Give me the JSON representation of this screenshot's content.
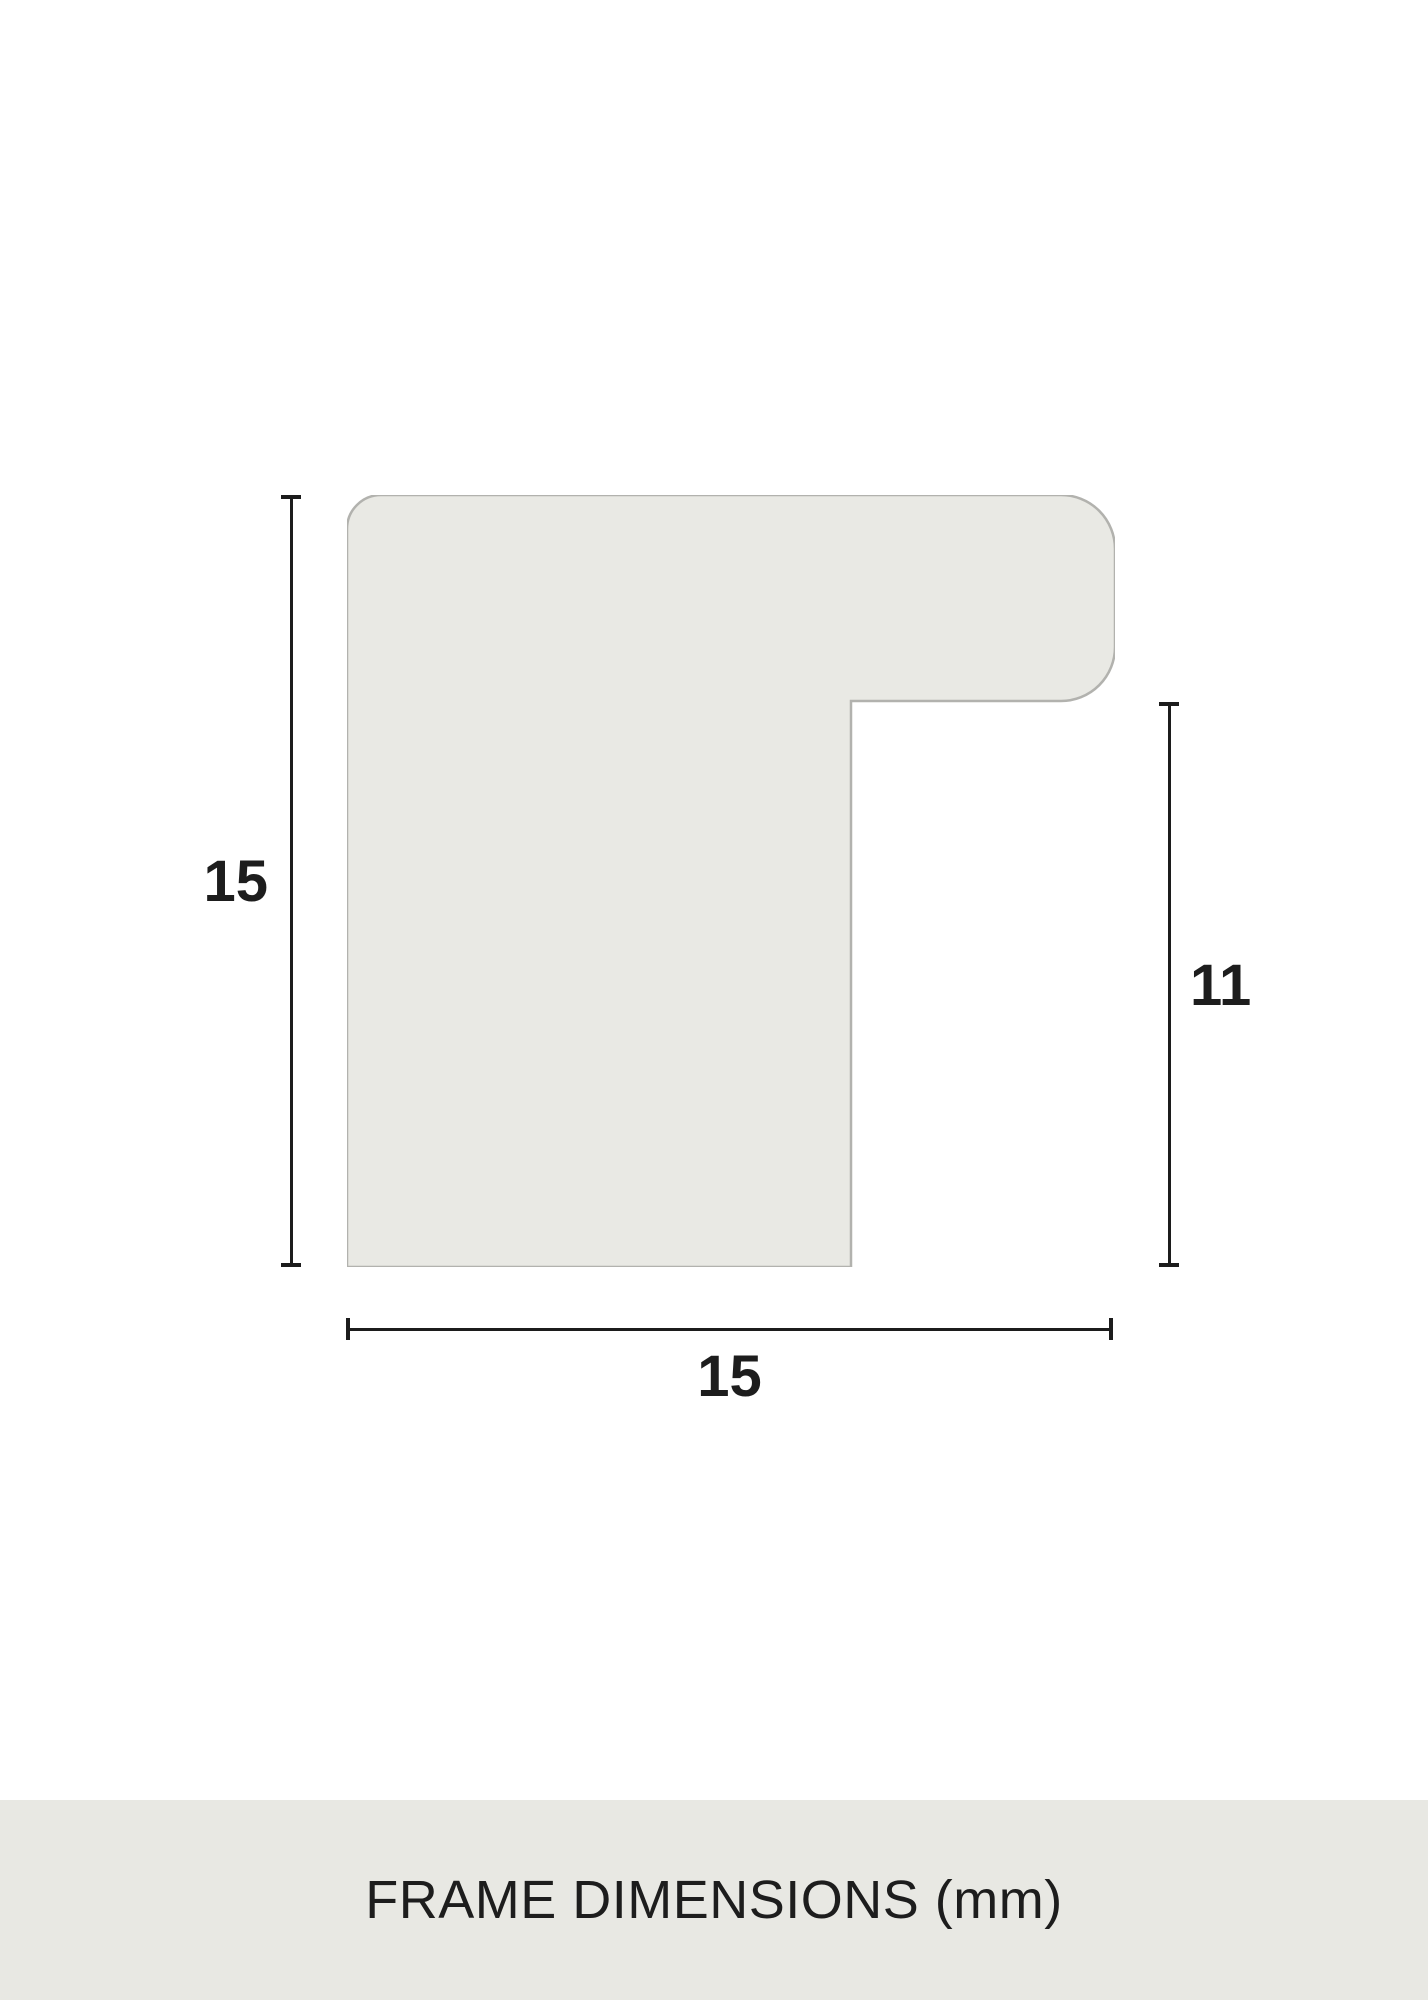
{
  "diagram": {
    "type": "frame-profile-cross-section",
    "unit": "mm",
    "dimensions": {
      "height": "15",
      "depth": "11",
      "width": "15"
    },
    "colors": {
      "canvas_bg": "#ffffff",
      "profile_fill": "#e9e9e4",
      "profile_border": "#b2b2ae",
      "dimension_line": "#1c1c1c",
      "footer_bg": "#e8e8e3",
      "text": "#1d1d1d"
    }
  },
  "footer": {
    "title": "FRAME DIMENSIONS (mm)"
  }
}
